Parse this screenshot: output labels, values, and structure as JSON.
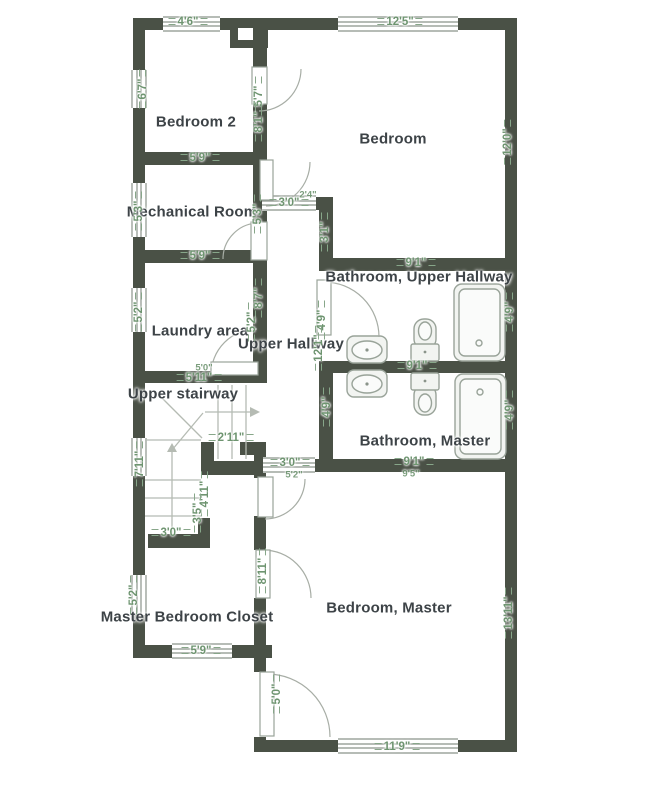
{
  "plan": {
    "colors": {
      "wall": "#4a5146",
      "dimension_text": "#6e9470",
      "room_text": "#3d4347",
      "fixture_stroke": "#99a399",
      "fixture_fill": "#f2f4f1",
      "stair_line": "#b5bbb3",
      "background": "#ffffff"
    },
    "rooms": [
      {
        "label": "Bedroom 2",
        "x": 196,
        "y": 122
      },
      {
        "label": "Bedroom",
        "x": 393,
        "y": 139
      },
      {
        "label": "Mechanical Room",
        "x": 192,
        "y": 212
      },
      {
        "label": "Bathroom, Upper Hallway",
        "x": 419,
        "y": 277
      },
      {
        "label": "Laundry area",
        "x": 200,
        "y": 331
      },
      {
        "label": "Upper Hallway",
        "x": 291,
        "y": 344
      },
      {
        "label": "Upper stairway",
        "x": 183,
        "y": 394
      },
      {
        "label": "Bathroom, Master",
        "x": 425,
        "y": 441
      },
      {
        "label": "Bedroom, Master",
        "x": 389,
        "y": 608
      },
      {
        "label": "Master Bedroom Closet",
        "x": 187,
        "y": 617
      }
    ],
    "dimensions": [
      {
        "label": "4'6\"",
        "x": 188,
        "y": 22,
        "orient": "h",
        "small": false
      },
      {
        "label": "12'5\"",
        "x": 400,
        "y": 22,
        "orient": "h",
        "small": false
      },
      {
        "label": "6'7\"",
        "x": 143,
        "y": 89,
        "orient": "v",
        "small": false
      },
      {
        "label": "5'7\"",
        "x": 259,
        "y": 96,
        "orient": "v",
        "small": false
      },
      {
        "label": "8'1\"",
        "x": 259,
        "y": 122,
        "orient": "v",
        "small": false
      },
      {
        "label": "12'0\"",
        "x": 508,
        "y": 142,
        "orient": "v",
        "small": false
      },
      {
        "label": "5'9\"",
        "x": 200,
        "y": 158,
        "orient": "h",
        "small": false
      },
      {
        "label": "5'3\"",
        "x": 139,
        "y": 211,
        "orient": "v",
        "small": false
      },
      {
        "label": "5'3\"",
        "x": 258,
        "y": 214,
        "orient": "v",
        "small": false
      },
      {
        "label": "3'0\"",
        "x": 289,
        "y": 203,
        "orient": "h",
        "small": false
      },
      {
        "label": "2'4\"",
        "x": 308,
        "y": 195,
        "orient": "h",
        "small": true
      },
      {
        "label": "3'1\"",
        "x": 325,
        "y": 232,
        "orient": "v",
        "small": false
      },
      {
        "label": "9'1\"",
        "x": 416,
        "y": 263,
        "orient": "h",
        "small": false
      },
      {
        "label": "5'9\"",
        "x": 200,
        "y": 256,
        "orient": "h",
        "small": false
      },
      {
        "label": "5'2\"",
        "x": 139,
        "y": 312,
        "orient": "v",
        "small": false
      },
      {
        "label": "8'7\"",
        "x": 259,
        "y": 298,
        "orient": "v",
        "small": false
      },
      {
        "label": "5'2\"",
        "x": 252,
        "y": 322,
        "orient": "v",
        "small": false
      },
      {
        "label": "4'9\"",
        "x": 322,
        "y": 320,
        "orient": "v",
        "small": false
      },
      {
        "label": "12'1\"",
        "x": 319,
        "y": 348,
        "orient": "v",
        "small": false
      },
      {
        "label": "9'1\"",
        "x": 417,
        "y": 366,
        "orient": "h",
        "small": false
      },
      {
        "label": "4'9\"",
        "x": 510,
        "y": 312,
        "orient": "v",
        "small": false
      },
      {
        "label": "4'9\"",
        "x": 510,
        "y": 410,
        "orient": "v",
        "small": false
      },
      {
        "label": "4'9\"",
        "x": 327,
        "y": 407,
        "orient": "v",
        "small": false
      },
      {
        "label": "5'0\"",
        "x": 204,
        "y": 368,
        "orient": "h",
        "small": true
      },
      {
        "label": "5'11\"",
        "x": 199,
        "y": 378,
        "orient": "h",
        "small": false
      },
      {
        "label": "2'11\"",
        "x": 231,
        "y": 438,
        "orient": "h",
        "small": false
      },
      {
        "label": "7'11\"",
        "x": 140,
        "y": 464,
        "orient": "v",
        "small": false
      },
      {
        "label": "4'11\"",
        "x": 205,
        "y": 494,
        "orient": "v",
        "small": false
      },
      {
        "label": "3'5\"",
        "x": 198,
        "y": 513,
        "orient": "v",
        "small": false
      },
      {
        "label": "3'0\"",
        "x": 290,
        "y": 463,
        "orient": "h",
        "small": false
      },
      {
        "label": "5'2\"",
        "x": 294,
        "y": 475,
        "orient": "h",
        "small": true
      },
      {
        "label": "9'1\"",
        "x": 414,
        "y": 462,
        "orient": "h",
        "small": false
      },
      {
        "label": "9'5\"",
        "x": 411,
        "y": 474,
        "orient": "h",
        "small": true
      },
      {
        "label": "3'0\"",
        "x": 171,
        "y": 533,
        "orient": "h",
        "small": false
      },
      {
        "label": "5'2\"",
        "x": 134,
        "y": 595,
        "orient": "v",
        "small": false
      },
      {
        "label": "8'11\"",
        "x": 263,
        "y": 571,
        "orient": "v",
        "small": false
      },
      {
        "label": "13'11\"",
        "x": 509,
        "y": 613,
        "orient": "v",
        "small": false
      },
      {
        "label": "5'9\"",
        "x": 201,
        "y": 651,
        "orient": "h",
        "small": false
      },
      {
        "label": "5'0\"",
        "x": 277,
        "y": 694,
        "orient": "v",
        "small": false
      },
      {
        "label": "11'9\"",
        "x": 397,
        "y": 747,
        "orient": "h",
        "small": false
      }
    ],
    "fixtures": [
      {
        "name": "bathtub-upper"
      },
      {
        "name": "bathtub-master"
      },
      {
        "name": "toilet-upper"
      },
      {
        "name": "toilet-master"
      },
      {
        "name": "sink-upper"
      },
      {
        "name": "sink-master"
      }
    ]
  }
}
